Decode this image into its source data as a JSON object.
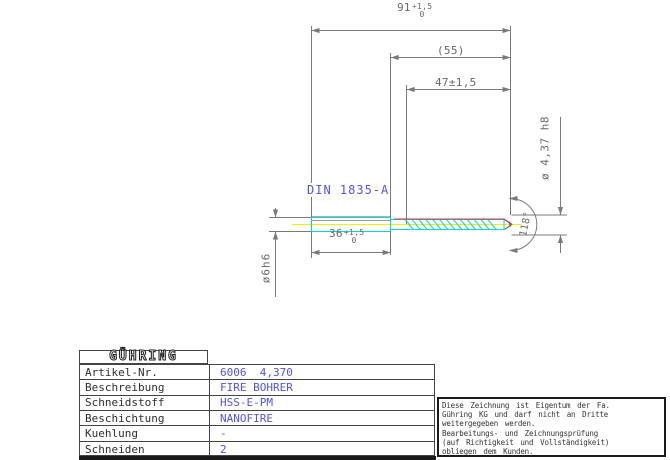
{
  "colors": {
    "accent_cyan": "#00d8d8",
    "accent_red": "#e73030",
    "accent_yellow": "#f0f000",
    "value_blue": "#5353dd",
    "line_gray": "#7a7a7a"
  },
  "drawing": {
    "din_label": "DIN 1835-A",
    "dims": {
      "total_length": {
        "main": "91",
        "tol_upper": "+1,5",
        "tol_lower": "0"
      },
      "ref_length": "(55)",
      "flute_length": "47±1,5",
      "shank_length": {
        "main": "36",
        "tol_upper": "+1,5",
        "tol_lower": "0"
      },
      "shank_dia": "ø6h6",
      "cutting_dia": "ø 4,37 h8",
      "point_angle": "118°"
    }
  },
  "table": {
    "logo": "GÜHRING",
    "rows": [
      {
        "label": "Artikel-Nr.",
        "value": "6006  4,370"
      },
      {
        "label": "Beschreibung",
        "value": "FIRE BOHRER"
      },
      {
        "label": "Schneidstoff",
        "value": "HSS-E-PM"
      },
      {
        "label": "Beschichtung",
        "value": "NANOFIRE"
      },
      {
        "label": "Kuehlung",
        "value": "-"
      },
      {
        "label": "Schneiden",
        "value": "2"
      }
    ]
  },
  "disclaimer": {
    "lines": [
      "Diese Zeichnung ist Eigentum der Fa.",
      "Gühring KG und darf nicht an Dritte",
      "weitergegeben werden.",
      "Bearbeitungs- und Zeichnungsprüfung",
      "(auf Richtigkeit und Vollständigkeit)",
      "obliegen dem Kunden."
    ]
  }
}
